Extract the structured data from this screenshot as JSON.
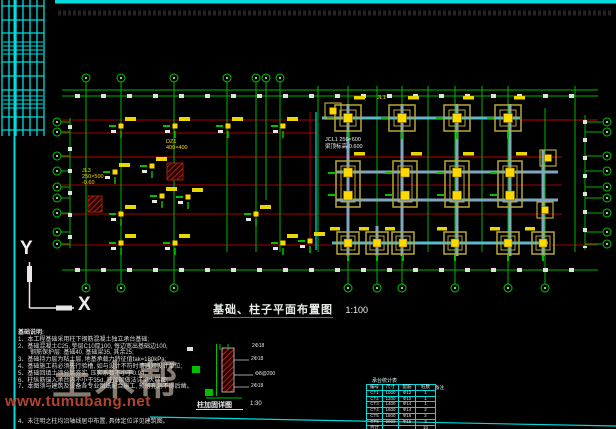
{
  "sheet": {
    "title": "基础、柱子平面布置图",
    "scale": "1:100",
    "ucs": {
      "x": "X",
      "y": "Y"
    }
  },
  "plan_labels": {
    "white_line1": "JCL1 250×600",
    "white_line2": "梁顶标高-0.600",
    "yellow_a1": "JL3",
    "yellow_a2": "250×500",
    "yellow_a3": "-0.60",
    "yellow_b1": "DZ1",
    "yellow_b2": "400×400",
    "yellow_c": "JL1"
  },
  "notes": {
    "heading": "基础说明:",
    "lines": [
      "1、本工程基础采用柱下钢筋混凝土独立承台基础;",
      "2、基础混凝土C25, 垫层C10厚100, 每边宽出基础边100,",
      "　　钢筋保护层: 基础40, 基础梁35, 其余25;",
      "3、基础持力层为粘土层, 地基承载力特征值fak=180kPa;",
      "4、基础施工前必须先行验槽, 如与设计不符时请通知设计单位;",
      "5、基础回填土须分层夯实, 压实系数不小于0.94;",
      "6、柱纵筋锚入承台内不小于35d, 柱加固做法详见大样图;",
      "7、本图须与建筑及设备各专业图纸配合施工, 预留孔洞不得后凿。"
    ],
    "last_line": "4、未注明之柱均沿轴线居中布置, 具体定位详见建筑图。"
  },
  "watermark": {
    "logo": "土木帮",
    "url": "www.tumubang.net"
  },
  "detail": {
    "caption": "柱加固详图",
    "scale": "1:30",
    "top_label": "2Φ18",
    "side_label_1": "2Φ18",
    "side_label_2": "Φ8@200",
    "side_label_3": "2Φ18"
  },
  "stats_table": {
    "title": "承台统计表",
    "note": "备注",
    "headers": [
      "编号",
      "尺寸",
      "配筋",
      "桩数"
    ],
    "rows": [
      [
        "CT1",
        "1000",
        "Φ12",
        "1"
      ],
      [
        "CT2",
        "1200",
        "Φ12",
        "1"
      ],
      [
        "CT3",
        "1400",
        "Φ14",
        "1"
      ],
      [
        "CT4",
        "1600",
        "Φ14",
        "2"
      ],
      [
        "CT5",
        "1800",
        "Φ16",
        "2"
      ],
      [
        "CT6",
        "2000",
        "Φ16",
        "3"
      ],
      [
        "合计",
        "",
        "",
        "10"
      ]
    ]
  },
  "colors": {
    "background": "#000000",
    "axis_green": "#00b400",
    "beam_red": "#a80000",
    "sheet_cyan": "#00dcdc",
    "column_yellow": "#ffd800",
    "cap_outline": "#b8a838",
    "watermark_red": "#c34b34"
  }
}
